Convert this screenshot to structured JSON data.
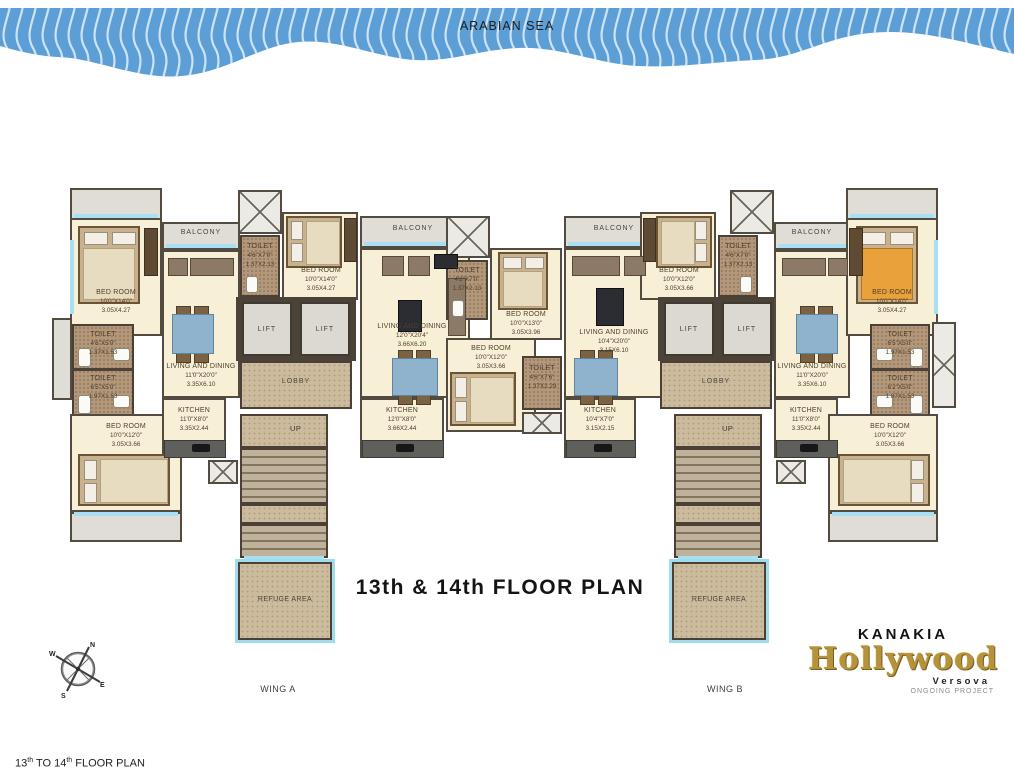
{
  "sea": {
    "label": "ARABIAN SEA"
  },
  "title": "13th & 14th FLOOR PLAN",
  "caption": {
    "p1": "13",
    "s1": "th",
    "p2": " TO 14",
    "s2": "th",
    "p3": " FLOOR PLAN"
  },
  "wing_a": "WING A",
  "wing_b": "WING B",
  "compass": {
    "n": "N",
    "e": "E",
    "s": "S",
    "w": "W"
  },
  "logo": {
    "brand": "KANAKIA",
    "name": "Hollywood",
    "location": "Versova",
    "status": "ONGOING PROJECT"
  },
  "labels": {
    "lift": "LIFT",
    "lobby": "LOBBY",
    "up": "UP",
    "refuge": "REFUGE AREA",
    "balcony": "BALCONY"
  },
  "colors": {
    "sea": "#5b9fd6",
    "room": "#f7f0d6",
    "wall": "#534b40",
    "window": "#a6e0f2",
    "toilet_floor": "#b2977b",
    "lobby_floor": "#cdbb9e",
    "gold": "#b5923c"
  },
  "rooms": {
    "bed_10x14": {
      "name": "BED ROOM",
      "ft": "10'0\"X14'0\"",
      "m": "3.05X4.27"
    },
    "bed_10x13": {
      "name": "BED ROOM",
      "ft": "10'0\"X13'0\"",
      "m": "3.05X3.96"
    },
    "bed_10x12": {
      "name": "BED ROOM",
      "ft": "10'0\"X12'0\"",
      "m": "3.05X3.66"
    },
    "living_11x20": {
      "name": "LIVING AND DINING",
      "ft": "11'0\"X20'0\"",
      "m": "3.35X6.10"
    },
    "living_12x20": {
      "name": "LIVING AND DINING",
      "ft": "12'0\"X20'4\"",
      "m": "3.66X6.20"
    },
    "living_10x20": {
      "name": "LIVING AND DINING",
      "ft": "10'4\"X20'0\"",
      "m": "3.15X6.10"
    },
    "kitchen_11x8": {
      "name": "KITCHEN",
      "ft": "11'0\"X8'0\"",
      "m": "3.35X2.44"
    },
    "kitchen_12x8": {
      "name": "KITCHEN",
      "ft": "12'0\"X8'0\"",
      "m": "3.66X2.44"
    },
    "kitchen_10x7": {
      "name": "KITCHEN",
      "ft": "10'4\"X7'0\"",
      "m": "3.15X2.15"
    },
    "toilet_46x50": {
      "name": "TOILET",
      "ft": "4'6\"X5'0\"",
      "m": "1.37X1.53"
    },
    "toilet_65x50": {
      "name": "TOILET",
      "ft": "6'5\"X5'0\"",
      "m": "1.97X1.53"
    },
    "toilet_62x50": {
      "name": "TOILET",
      "ft": "6'2\"X5'0\"",
      "m": "1.87X1.53"
    },
    "toilet_46x70": {
      "name": "TOILET",
      "ft": "4'6\"X7'0\"",
      "m": "1.37X2.13"
    },
    "toilet_42x70": {
      "name": "TOILET",
      "ft": "4'2\"X7'0\"",
      "m": "1.37X2.13"
    },
    "toilet_46x76": {
      "name": "TOILET",
      "ft": "4'6\"X7'6\"",
      "m": "1.37X2.29"
    }
  }
}
